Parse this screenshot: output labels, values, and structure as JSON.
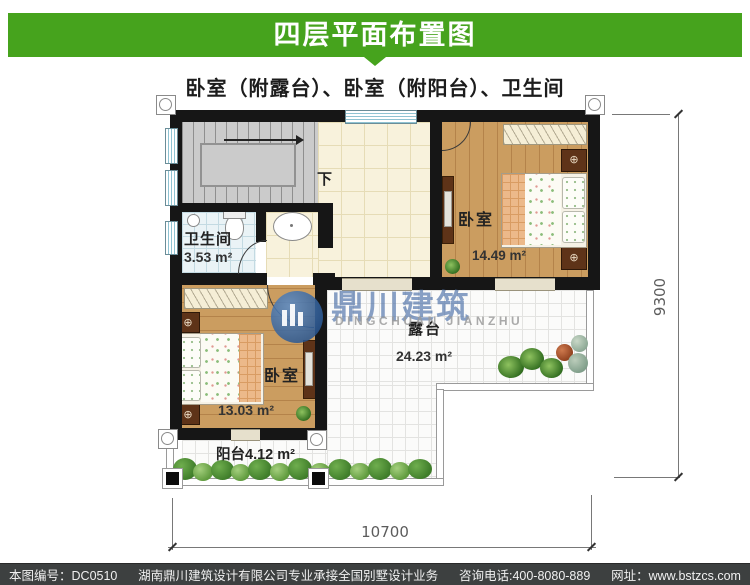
{
  "header": {
    "title": "四层平面布置图",
    "subtitle": "卧室（附露台）、卧室（附阳台）、卫生间",
    "accent_color": "#46a31d"
  },
  "rooms": {
    "bathroom": {
      "name": "卫生间",
      "area": "3.53 m²"
    },
    "bedroom_right": {
      "name": "卧室",
      "area": "14.49 m²"
    },
    "bedroom_left": {
      "name": "卧室",
      "area": "13.03 m²"
    },
    "terrace": {
      "name": "露台",
      "area": "24.23 m²"
    },
    "balcony": {
      "name": "阳台",
      "area": "4.12 m²"
    },
    "stairs": {
      "down_label": "下"
    }
  },
  "dimensions": {
    "bottom": "10700",
    "right": "9300"
  },
  "watermark": {
    "cn": "鼎川建筑",
    "en": "DINGCHUAN JIANZHU"
  },
  "icons": {
    "nightstand_knob": "⊕"
  },
  "footer": {
    "number_label": "本图编号：",
    "number": "DC0510",
    "company": "湖南鼎川建筑设计有限公司专业承接全国别墅设计业务",
    "phone": "咨询电话:400-8080-889",
    "website": "网址：www.bstzcs.com"
  }
}
